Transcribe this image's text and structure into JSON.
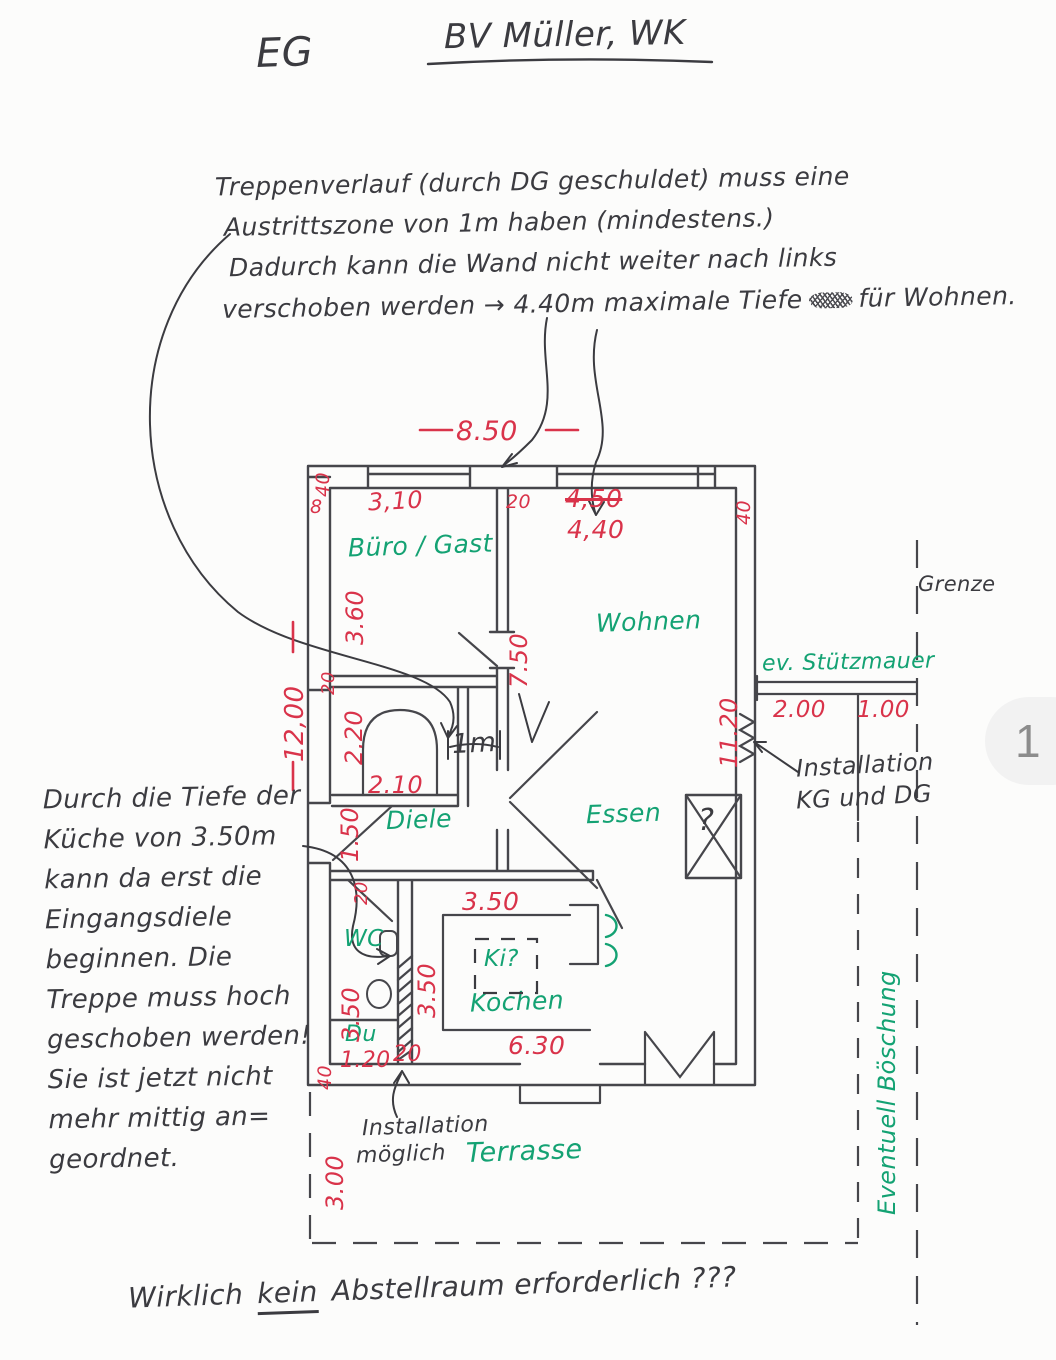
{
  "header": {
    "floor_label": "EG",
    "project_title": "BV Müller, WK"
  },
  "top_note": {
    "lines": [
      "Treppenverlauf (durch DG geschuldet) muss eine",
      "Austrittszone von 1m haben (mindestens.)",
      "Dadurch kann die Wand nicht weiter nach links",
      "verschoben werden → 4.40m maximale Tiefe",
      "für Wohnen."
    ]
  },
  "left_note": {
    "lines": [
      "Durch die Tiefe der",
      "Küche von 3.50m",
      "kann da erst die",
      "Eingangsdiele",
      "beginnen. Die",
      "Treppe muss hoch",
      "geschoben werden!",
      "Sie ist jetzt nicht",
      "mehr mittig an=",
      "geordnet."
    ]
  },
  "bottom_note": {
    "prefix": "Wirklich",
    "emphasized": "kein",
    "suffix": "Abstellraum erforderlich ???"
  },
  "rooms": {
    "buero": "Büro / Gast",
    "wohnen": "Wohnen",
    "essen": "Essen",
    "diele": "Diele",
    "wc": "WC",
    "du": "Du",
    "kochen": "Kochen",
    "kitchen_island": "Ki?",
    "terrasse": "Terrasse"
  },
  "site": {
    "grenze": "Grenze",
    "stuetzmauer": "ev. Stützmauer",
    "boeschung": "Eventuell Böschung"
  },
  "annotations": {
    "installation_shaft_l1": "Installation",
    "installation_shaft_l2": "möglich",
    "installation_right_l1": "Installation",
    "installation_right_l2": "KG und DG",
    "one_meter": "1m",
    "shaft_question": "?"
  },
  "dimensions": {
    "total_width": "8.50",
    "total_depth": "12,00",
    "buero_width": "3,10",
    "wall_20_top": "20",
    "wohnen_width_old": "4,50",
    "wohnen_width_new": "4,40",
    "wall_40_right_top": "40",
    "wall_40_top_left": "40",
    "wall_8_top_left": "8",
    "buero_depth": "3.60",
    "wohnen_depth": "7.50",
    "wall_20_left": "20",
    "stair_width": "2.20",
    "stair_length": "2.10",
    "entry_door": "1.50",
    "wall_20_wc": "20",
    "wc_zone_depth": "3.50",
    "kitchen_depth_side": "3.50",
    "kitchen_opening": "3.50",
    "du_width": "1.20",
    "shaft_20": "20",
    "kitchen_width": "6.30",
    "wall_40_bottom_left": "40",
    "terrace_depth": "3.00",
    "right_inner_depth": "11.20",
    "stuetzmauer_length": "2.00",
    "stuetzmauer_gap": "1.00"
  },
  "page": {
    "badge": "1"
  },
  "colors": {
    "dimension_red": "#d9334a",
    "marker_green": "#14a273",
    "pencil_ink": "#3b3b40",
    "badge_bg": "#f2f2f2",
    "badge_text": "#8c8c8c"
  }
}
